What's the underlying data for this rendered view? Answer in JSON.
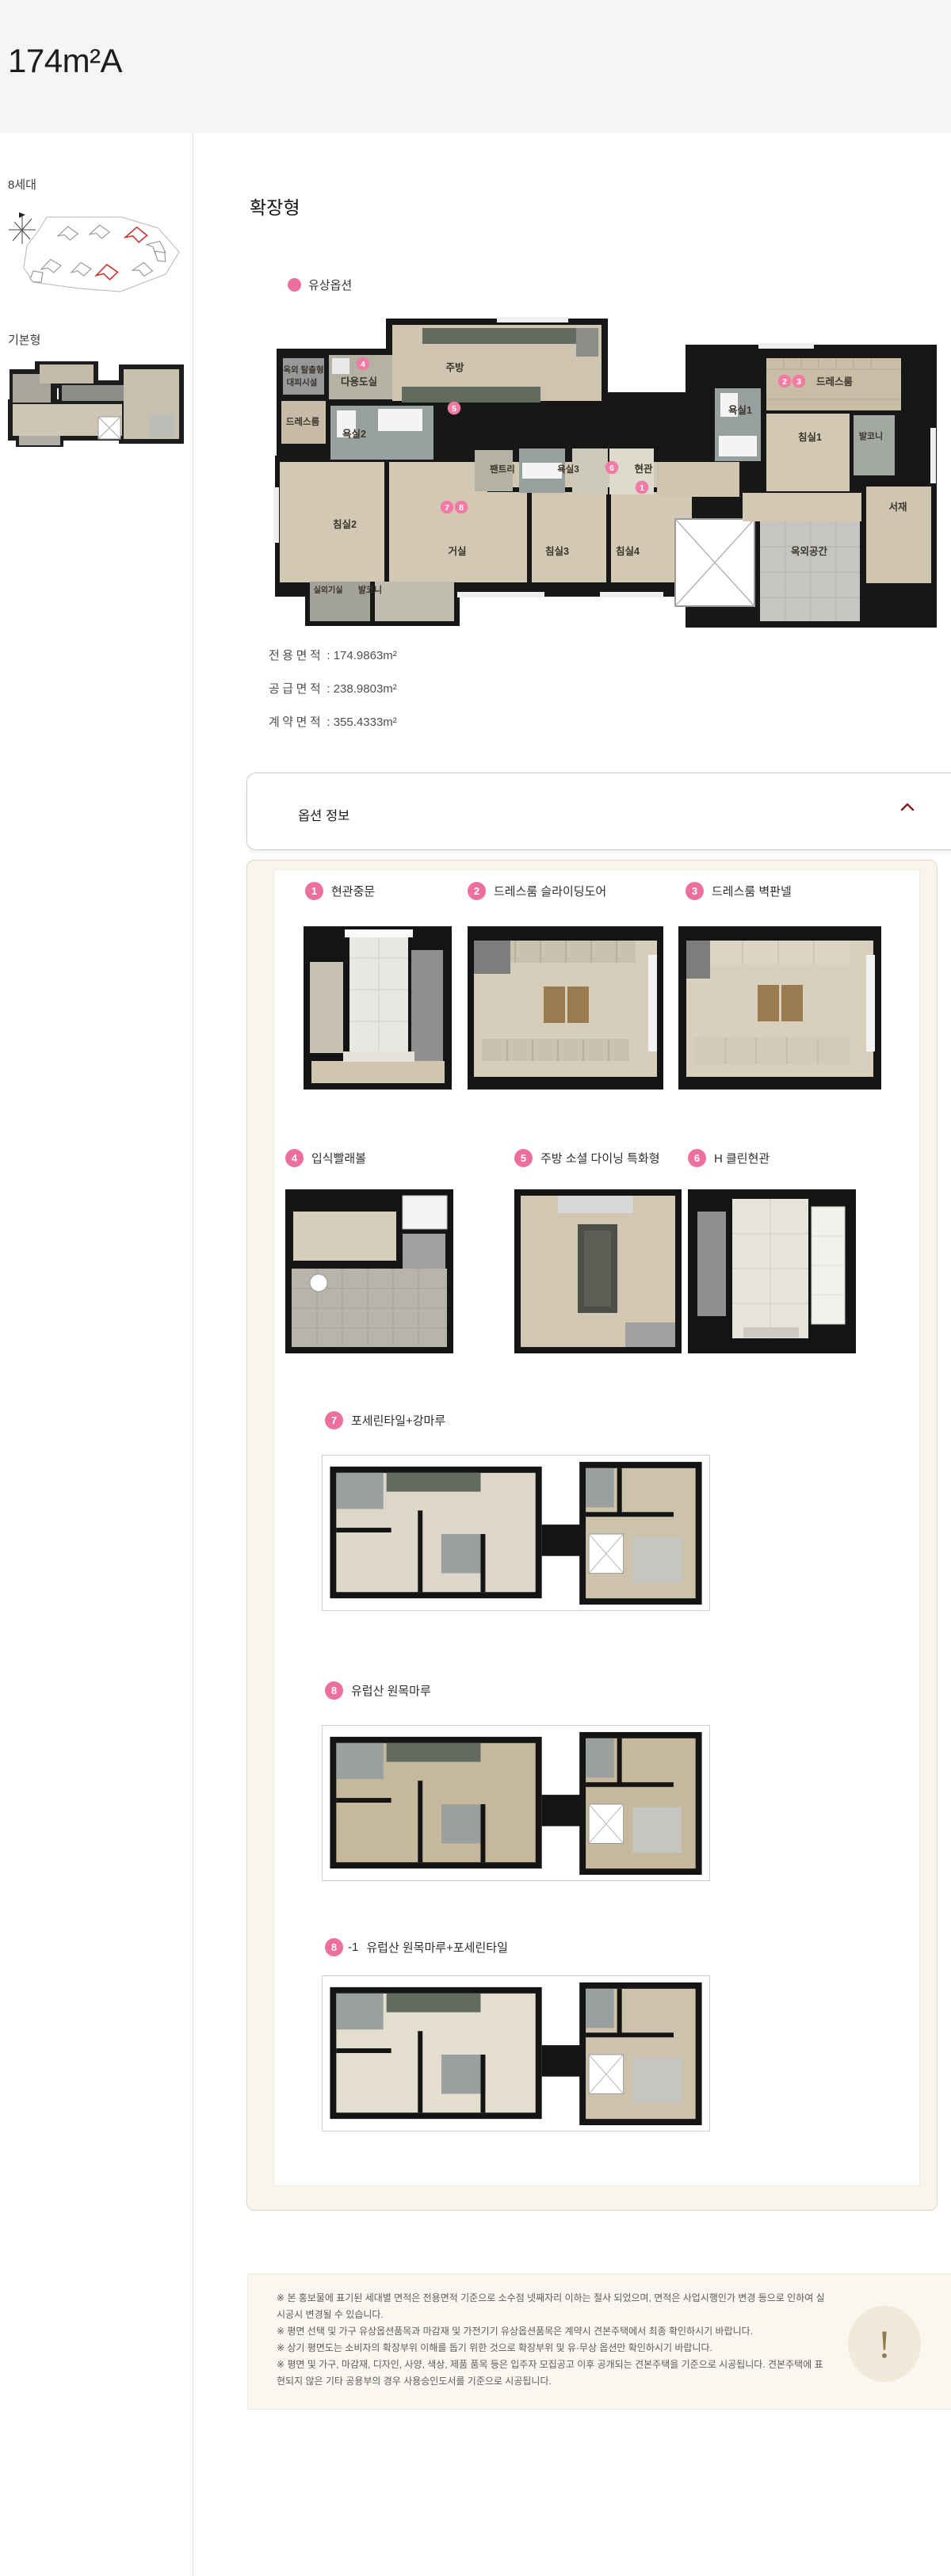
{
  "page": {
    "title": "174m²A"
  },
  "sidebar": {
    "site_label": "8세대",
    "compass": "N",
    "base_label": "기본형"
  },
  "main": {
    "heading": "확장형",
    "legend_label": "유상옵션",
    "areas": [
      {
        "label": "전용면적",
        "sep": " : ",
        "value": "174.9863m²"
      },
      {
        "label": "공급면적",
        "sep": " : ",
        "value": "238.9803m²"
      },
      {
        "label": "계약면적",
        "sep": " : ",
        "value": "355.4333m²"
      }
    ]
  },
  "plan": {
    "rooms": {
      "escape1": "옥외 탈출형",
      "escape2": "대피시설",
      "utility": "다용도실",
      "kitchen": "주방",
      "dress_left": "드레스룸",
      "bath2": "욕실2",
      "pantry": "팬트리",
      "bath3": "욕실3",
      "entry": "현관",
      "bath1": "욕실1",
      "dress_right": "드레스룸",
      "bed1": "침실1",
      "balcony_right": "발코니",
      "study": "서재",
      "outdoor": "옥외공간",
      "bed2": "침실2",
      "living": "거실",
      "bed3": "침실3",
      "bed4": "침실4",
      "ac_room": "실외기실",
      "balcony_bottom": "발코니"
    }
  },
  "option_panel": {
    "title": "옵션 정보"
  },
  "options": [
    {
      "num": "1",
      "label": "현관중문"
    },
    {
      "num": "2",
      "label": "드레스룸 슬라이딩도어"
    },
    {
      "num": "3",
      "label": "드레스룸 벽판넬"
    },
    {
      "num": "4",
      "label": "입식빨래볼"
    },
    {
      "num": "5",
      "label": "주방 소셜 다이닝 특화형"
    },
    {
      "num": "6",
      "label": "H 클린현관"
    },
    {
      "num": "7",
      "label": "포세린타일+강마루"
    },
    {
      "num": "8",
      "label": "유럽산 원목마루"
    },
    {
      "num": "8",
      "suffix": "-1",
      "label": "유럽산 원목마루+포세린타일"
    }
  ],
  "disclaimer": {
    "badge": "!",
    "lines": [
      "※ 본 홍보물에 표기된 세대별 면적은 전용면적 기준으로 소수점 넷째자리 이하는 절사 되었으며, 면적은 사업시행인가 변경 등으로 인하여 실 시공시 변경될 수 있습니다.",
      "※ 평면 선택 및 가구 유상옵션품목과 마감재 및 가전기기 유상옵션품목은 계약시 견본주택에서 최종 확인하시기 바랍니다.",
      "※ 상기 평면도는 소비자의 확장부위 이해를 돕기 위한 것으로 확장부위 및 유·무상 옵션만 확인하시기 바랍니다.",
      "※ 평면 및 가구, 마감재, 디자인, 사양, 색상, 제품 품목 등은 입주자 모집공고 이후 공개되는 견본주택을 기준으로 시공됩니다. 견본주택에 표현되지 않은 기타 공용부의 경우 사용승인도서를 기준으로 시공됩니다."
    ]
  }
}
